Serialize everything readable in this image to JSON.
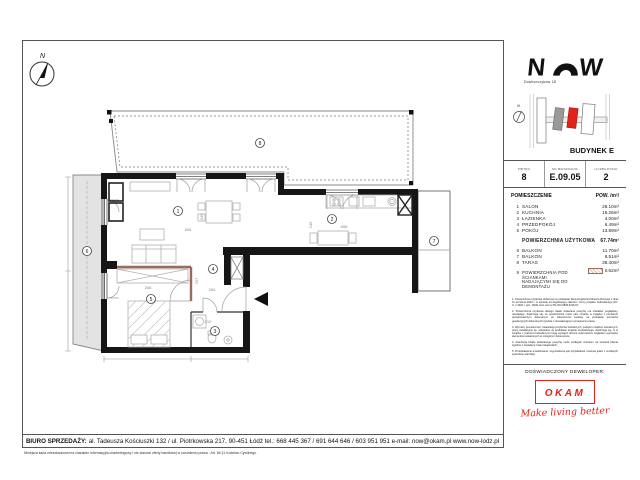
{
  "page": {
    "sales_label": "BIURO SPRZEDAŻY:",
    "sales_office": "al. Tadeusza Kościuszki 132 / ul. Piotrkowska 217, 90-451 Łódź tel.: 668 445 367 / 691 644 646 / 603 951 951 e-mail: now@okam.pl www.now-lodz.pl",
    "footnote": "Niniejsza karta mieszkaniowa ma charakter informacyjno-marketingowy i nie stanowi oferty handlowej w rozumieniu prawa - Art. 66 §1 Kodeksu Cywilnego."
  },
  "brand": {
    "logo_text": "NOW",
    "logo_subtitle": "Dowborczyków 18",
    "building_label": "BUDYNEK E",
    "developer_heading": "DOŚWIADCZONY DEWELOPER:",
    "developer_name": "OKAM",
    "developer_slogan": "Make living better",
    "accent_red": "#e2231a"
  },
  "unit_info": {
    "floor_label": "PIĘTRO",
    "floor_value": "8",
    "apt_label": "NR MIESZKANIA",
    "apt_value": "E.09.05",
    "rooms_label": "LICZBA POKOI",
    "rooms_value": "2"
  },
  "rooms": {
    "header_name": "POMIESZCZENIE",
    "header_area": "POW. /m²/",
    "items": [
      {
        "no": "1",
        "name": "SALON",
        "area": "28.10m²"
      },
      {
        "no": "2",
        "name": "KUCHNIA",
        "area": "15.26m²"
      },
      {
        "no": "3",
        "name": "ŁAZIENKA",
        "area": "4.00m²"
      },
      {
        "no": "4",
        "name": "PRZEDPOKÓJ",
        "area": "6.49m²"
      },
      {
        "no": "5",
        "name": "POKÓJ",
        "area": "13.89m²"
      }
    ],
    "total_label": "POWIERZCHNIA UŻYTKOWA",
    "total_area": "67.74m²",
    "extras": [
      {
        "no": "6",
        "name": "BALKON",
        "area": "11.70m²"
      },
      {
        "no": "7",
        "name": "BALKON",
        "area": "6.51m²"
      },
      {
        "no": "8",
        "name": "TARAS",
        "area": "38.40m²"
      }
    ],
    "extra9": {
      "no": "9",
      "name_line1": "POWIERZCHNIA POD ŚCIANKAMI",
      "name_line2": "NADAJĄCYMI SIĘ DO DEMONTAŻU",
      "area": "0.62m²"
    }
  },
  "legal_notes": [
    "1. Powierzchnia użytkowa obliczona na podstawie Rozporządzenia Ministra Rozwoju z dnia 11 września 2020 r. w sprawie szczegółowego zakresu i formy projektu budowlanego (Dz. U. z 2020 r. poz. 1609) oraz normy PN-ISO 9836:2015-07.",
    "2. Powierzchnia użytkowa danego lokalu wskazana powyżej ma charakter poglądowy, niewiążący. Zastrzega się, że powierzchnia może ulec zmianie w związku z pomiarem powykonawczym dokonanym po zakończeniu budowy na podstawie pomiarów geodezyjnych dokonanych zgodnie z obowiązującymi przepisami prawa.",
    "3. Wymiary pomieszczeń, lokalizacja przyborów sanitarnych, podejść urządzeń sanitarnych, piony instalacyjne itp. wskazano na podstawie projektu budowlanego. Zastrzega się, iż w związku z pracami budowlanymi mogą wystąpić różnice wykonawcze względem wymiarów elementów wskazanych w niniejszym dokumencie.",
    "4. Aranżacja lokalu pokazanego powyżej może podlegać zmianom na wniosek klienta zgodnie z zasadami zmian lokatorskich.",
    "5. Przedstawione umeblowanie i wyposażenie jest przykładowe i stanowi jeden z możliwych sposobów aranżacji."
  ],
  "plan": {
    "north_label": "N",
    "room_numbers": [
      "1",
      "2",
      "3",
      "4",
      "5",
      "6",
      "7",
      "8"
    ],
    "dimensions": [
      "805",
      "346",
      "658",
      "246",
      "268",
      "264",
      "257",
      "210"
    ]
  }
}
